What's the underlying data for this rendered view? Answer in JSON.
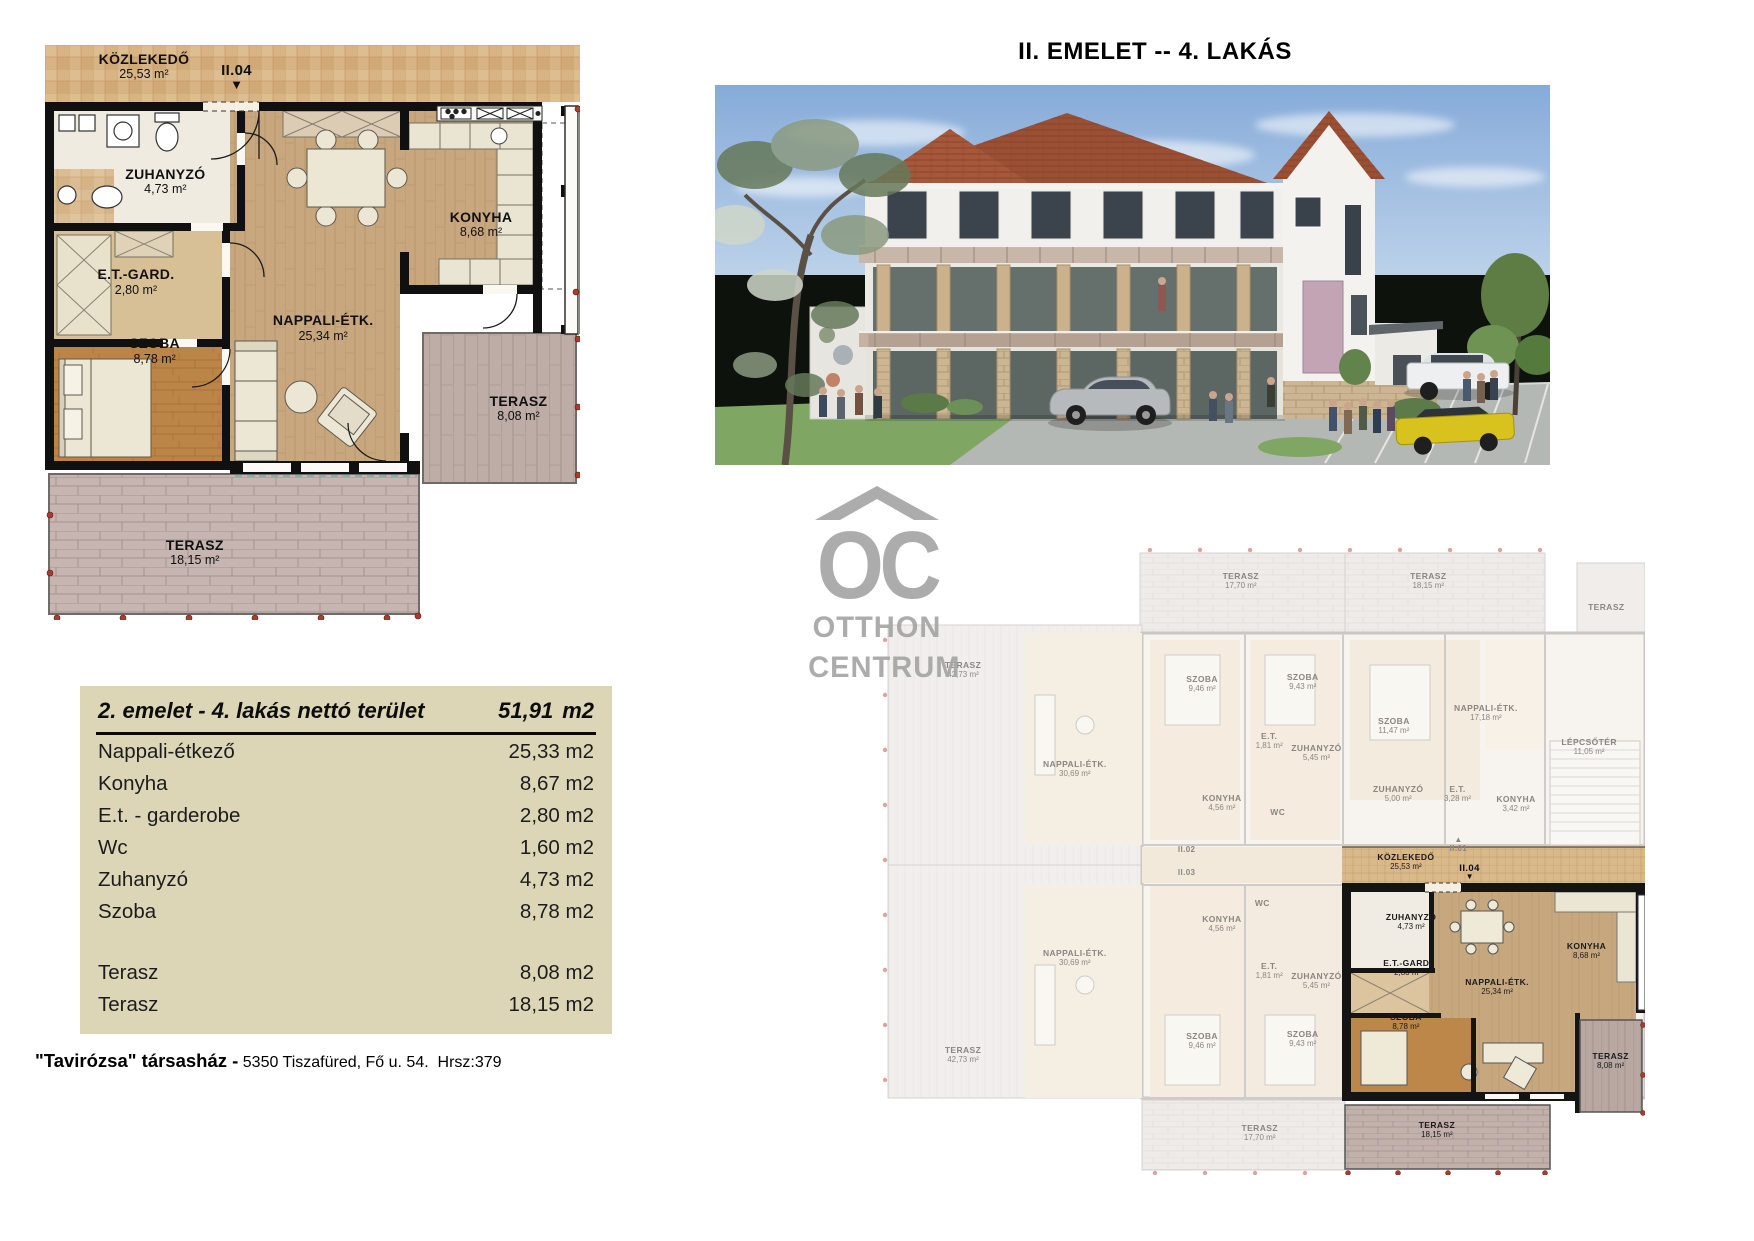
{
  "page": {
    "title": "II. EMELET -- 4. LAKÁS",
    "footer": {
      "bold": "\"Tavirózsa\" társasház -",
      "text": "5350 Tiszafüred, Fő u. 54.  Hrsz:379"
    }
  },
  "watermark": {
    "initials": "OC",
    "word1": "OTTHON",
    "word2": "CENTRUM"
  },
  "colors": {
    "table_bg": "#dcd6b6",
    "corridor_tile": "#d8b484",
    "wall": "#101010",
    "wood_living": "#c8a77e",
    "wood_bedroom": "#bc8548",
    "terrace_brick": "#c6b5b0",
    "roof": "#9c5033",
    "watermark_gray": "#a5a5a5",
    "survey_dot": "#a93b2e"
  },
  "floor_plan": {
    "labels": [
      {
        "t": "KÖZLEKEDŐ",
        "a": "25,53 m²",
        "x": 18.5,
        "y": 1.0
      },
      {
        "t": "II.04",
        "a": "",
        "x": 35.8,
        "y": 3.0,
        "cls": "marker",
        "arrow": "down"
      },
      {
        "t": "ZUHANYZÓ",
        "a": "4,73 m²",
        "x": 22.5,
        "y": 21.0
      },
      {
        "t": "E.T.-GARD.",
        "a": "2,80 m²",
        "x": 17.0,
        "y": 38.5
      },
      {
        "t": "SZOBA",
        "a": "8,78 m²",
        "x": 20.5,
        "y": 50.5
      },
      {
        "t": "NAPPALI-ÉTK.",
        "a": "25,34 m²",
        "x": 52.0,
        "y": 46.5
      },
      {
        "t": "KONYHA",
        "a": "8,68 m²",
        "x": 81.5,
        "y": 28.5
      },
      {
        "t": "TERASZ",
        "a": "8,08 m²",
        "x": 88.5,
        "y": 60.5
      },
      {
        "t": "TERASZ",
        "a": "18,15 m²",
        "x": 28.0,
        "y": 85.5
      }
    ]
  },
  "site_plan": {
    "labels": [
      {
        "t": "TERASZ",
        "a": "17,70 m²",
        "x": 53.0,
        "y": 4.2
      },
      {
        "t": "TERASZ",
        "a": "18,15 m²",
        "x": 74.8,
        "y": 4.2
      },
      {
        "t": "TERASZ",
        "a": "",
        "x": 95.5,
        "y": 9.0
      },
      {
        "t": "TERASZ",
        "a": "42,73 m²",
        "x": 20.7,
        "y": 18.3
      },
      {
        "t": "SZOBA",
        "a": "9,46 m²",
        "x": 48.5,
        "y": 20.4
      },
      {
        "t": "SZOBA",
        "a": "9,43 m²",
        "x": 60.2,
        "y": 20.2
      },
      {
        "t": "NAPPALI-ÉTK.",
        "a": "17,18 m²",
        "x": 81.5,
        "y": 25.0
      },
      {
        "t": "SZOBA",
        "a": "11,47 m²",
        "x": 70.8,
        "y": 27.2
      },
      {
        "t": "LÉPCSŐTÉR",
        "a": "11,05 m²",
        "x": 93.5,
        "y": 30.4
      },
      {
        "t": "E.T.",
        "a": "1,81 m²",
        "x": 56.3,
        "y": 29.6
      },
      {
        "t": "ZUHANYZÓ",
        "a": "5,45 m²",
        "x": 61.8,
        "y": 31.4
      },
      {
        "t": "NAPPALI-ÉTK.",
        "a": "30,69 m²",
        "x": 33.7,
        "y": 34.0
      },
      {
        "t": "ZUHANYZÓ",
        "a": "5,00 m²",
        "x": 71.3,
        "y": 38.0
      },
      {
        "t": "E.T.",
        "a": "3,28 m²",
        "x": 78.2,
        "y": 38.0
      },
      {
        "t": "KONYHA",
        "a": "3,42 m²",
        "x": 85.0,
        "y": 39.6
      },
      {
        "t": "KONYHA",
        "a": "4,56 m²",
        "x": 50.8,
        "y": 39.4
      },
      {
        "t": "WC",
        "a": "",
        "x": 57.3,
        "y": 41.6
      },
      {
        "t": "II.01",
        "a": "",
        "x": 78.3,
        "y": 46.4,
        "cls": "sm",
        "arrow": "up"
      },
      {
        "t": "II.02",
        "a": "",
        "x": 46.7,
        "y": 47.6,
        "cls": "sm"
      },
      {
        "t": "II.03",
        "a": "",
        "x": 46.7,
        "y": 51.2,
        "cls": "sm"
      },
      {
        "t": "KÖZLEKEDŐ",
        "a": "25,53 m²",
        "x": 72.2,
        "y": 48.8,
        "cls": "sd"
      },
      {
        "t": "II.04",
        "a": "",
        "x": 79.6,
        "y": 50.4,
        "cls": "sdm",
        "arrow": "down"
      },
      {
        "t": "WC",
        "a": "",
        "x": 55.5,
        "y": 56.0
      },
      {
        "t": "KONYHA",
        "a": "4,56 m²",
        "x": 50.8,
        "y": 58.5
      },
      {
        "t": "ZUHANYZÓ",
        "a": "4,73 m²",
        "x": 72.8,
        "y": 58.2,
        "cls": "sd"
      },
      {
        "t": "KONYHA",
        "a": "8,68 m²",
        "x": 93.2,
        "y": 62.8,
        "cls": "sd"
      },
      {
        "t": "NAPPALI-ÉTK.",
        "a": "30,69 m²",
        "x": 33.7,
        "y": 64.0
      },
      {
        "t": "E.T.",
        "a": "1,81 m²",
        "x": 56.3,
        "y": 66.0
      },
      {
        "t": "E.T.-GARD.",
        "a": "2,80 m²",
        "x": 72.4,
        "y": 65.6,
        "cls": "sd"
      },
      {
        "t": "ZUHANYZÓ",
        "a": "5,45 m²",
        "x": 61.8,
        "y": 67.6
      },
      {
        "t": "NAPPALI-ÉTK.",
        "a": "25,34 m²",
        "x": 82.8,
        "y": 68.5,
        "cls": "sd"
      },
      {
        "t": "SZOBA",
        "a": "8,78 m²",
        "x": 72.2,
        "y": 74.2,
        "cls": "sd"
      },
      {
        "t": "SZOBA",
        "a": "9,43 m²",
        "x": 60.2,
        "y": 76.8
      },
      {
        "t": "SZOBA",
        "a": "9,46 m²",
        "x": 48.5,
        "y": 77.2
      },
      {
        "t": "TERASZ",
        "a": "42,73 m²",
        "x": 20.7,
        "y": 79.4
      },
      {
        "t": "TERASZ",
        "a": "8,08 m²",
        "x": 96.0,
        "y": 80.3,
        "cls": "sd"
      },
      {
        "t": "TERASZ",
        "a": "17,70 m²",
        "x": 55.2,
        "y": 91.8
      },
      {
        "t": "TERASZ",
        "a": "18,15 m²",
        "x": 75.8,
        "y": 91.3,
        "cls": "sd"
      }
    ]
  },
  "area_table": {
    "header": {
      "label": "2. emelet - 4. lakás nettó terület",
      "value": "51,91",
      "unit": "m2"
    },
    "rows": [
      {
        "label": "Nappali-étkező",
        "value": "25,33",
        "unit": "m2"
      },
      {
        "label": "Konyha",
        "value": "8,67",
        "unit": "m2"
      },
      {
        "label": "E.t. - garderobe",
        "value": "2,80",
        "unit": "m2"
      },
      {
        "label": "Wc",
        "value": "1,60",
        "unit": "m2"
      },
      {
        "label": "Zuhanyzó",
        "value": "4,73",
        "unit": "m2"
      },
      {
        "label": "Szoba",
        "value": "8,78",
        "unit": "m2"
      },
      {
        "label": "Terasz",
        "value": "8,08",
        "unit": "m2",
        "gap": true
      },
      {
        "label": "Terasz",
        "value": "18,15",
        "unit": "m2"
      }
    ]
  }
}
